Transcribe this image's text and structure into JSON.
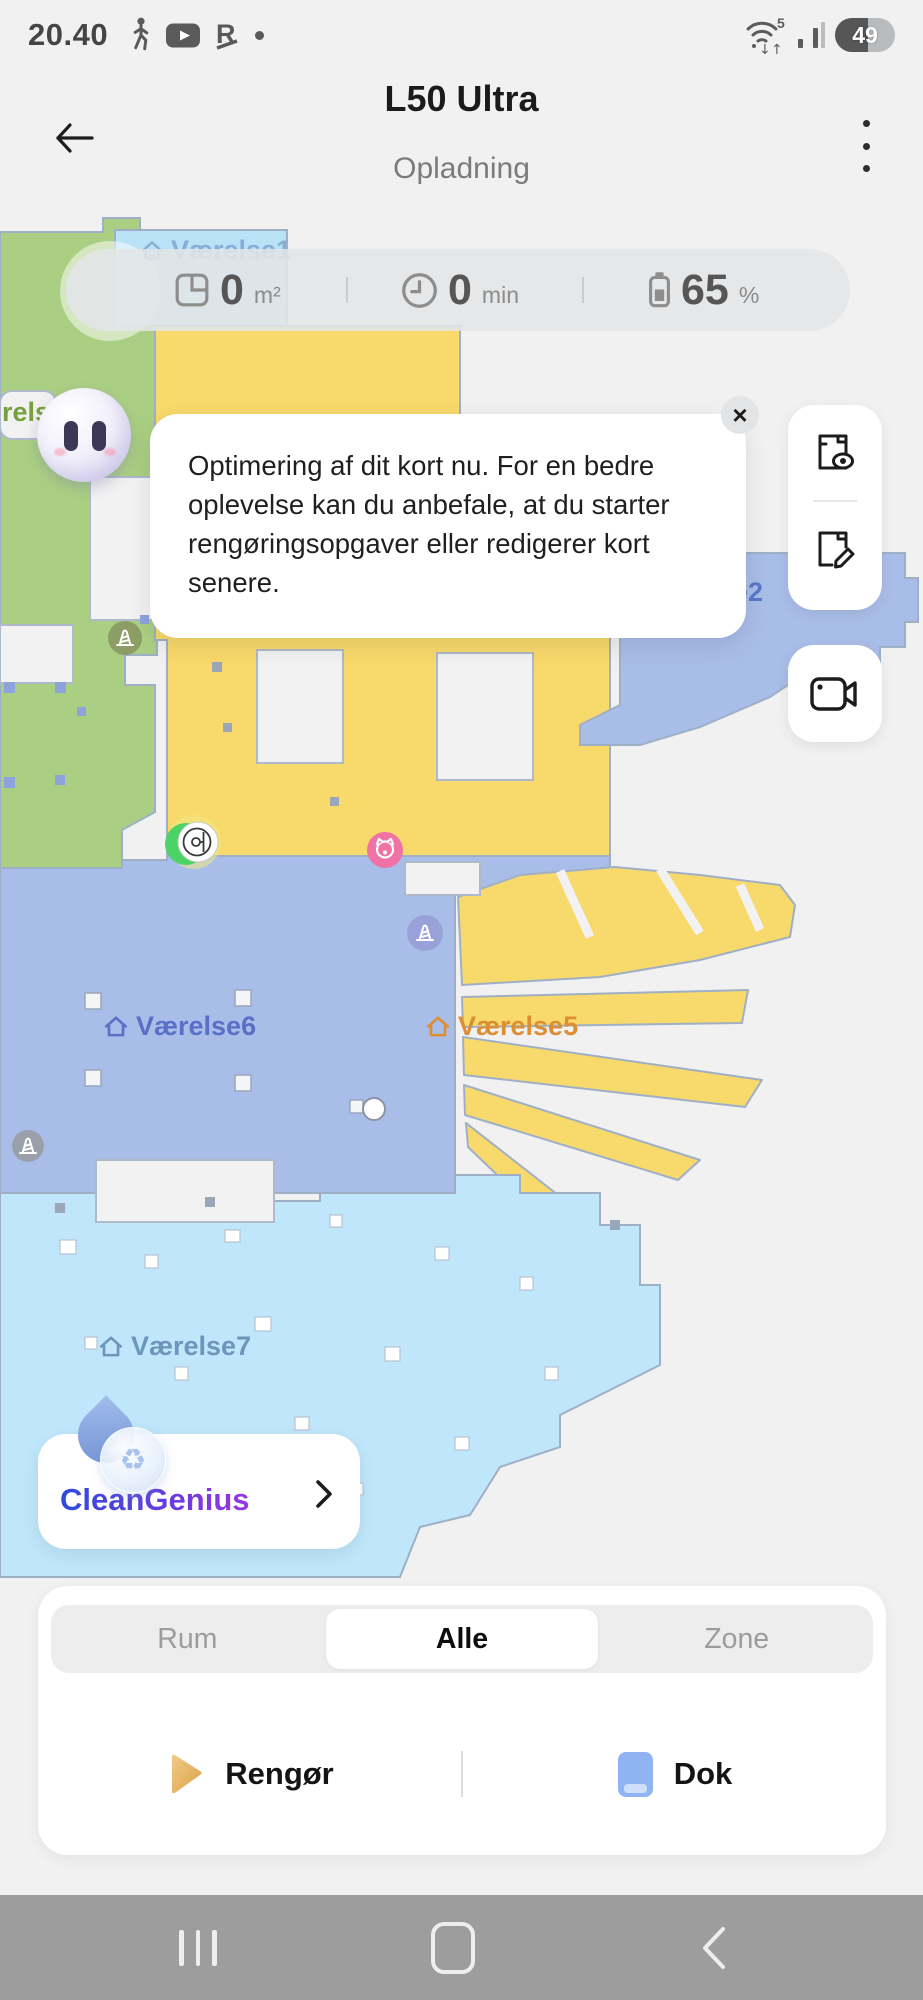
{
  "status_bar": {
    "time": "20.40",
    "wifi_label": "5",
    "battery": "49"
  },
  "header": {
    "title": "L50 Ultra",
    "subtitle": "Opladning"
  },
  "stats": {
    "area_value": "0",
    "area_unit": "m²",
    "time_value": "0",
    "time_unit": "min",
    "battery_value": "65",
    "battery_unit": "%"
  },
  "notice": {
    "text": "Optimering af dit kort nu. For en bedre oplevelse kan du anbefale, at du starter rengøringsopgaver eller redigerer kort senere.",
    "close": "×"
  },
  "map": {
    "labels": {
      "room1": "Værelse1",
      "room2": "e2",
      "room3": "rels",
      "room5": "Værelse5",
      "room6": "Værelse6",
      "room7": "Værelse7"
    }
  },
  "cleangenius": {
    "label": "CleanGenius",
    "icon": "♻"
  },
  "panel": {
    "tabs": [
      {
        "label": "Rum"
      },
      {
        "label": "Alle"
      },
      {
        "label": "Zone"
      }
    ],
    "selected_tab": "Alle",
    "actions": {
      "clean": "Rengør",
      "dock": "Dok"
    }
  },
  "colors": {
    "room_green": "#aacf82",
    "room_yellow": "#f8d96b",
    "room_periwinkle": "#a9bde9",
    "room_lightblue": "#b9e2f7",
    "room_cyan": "#bfe6fa",
    "map_border": "#9fb0c6",
    "robot_green": "#4bd465",
    "pet_pink": "#f173a5",
    "cleangenius_start": "#2f4bdb",
    "cleangenius_end": "#9a35e6",
    "play_orange": "#e2a651",
    "dock_blue": "#8fb3f3",
    "nav_gray": "#9d9d9d"
  }
}
